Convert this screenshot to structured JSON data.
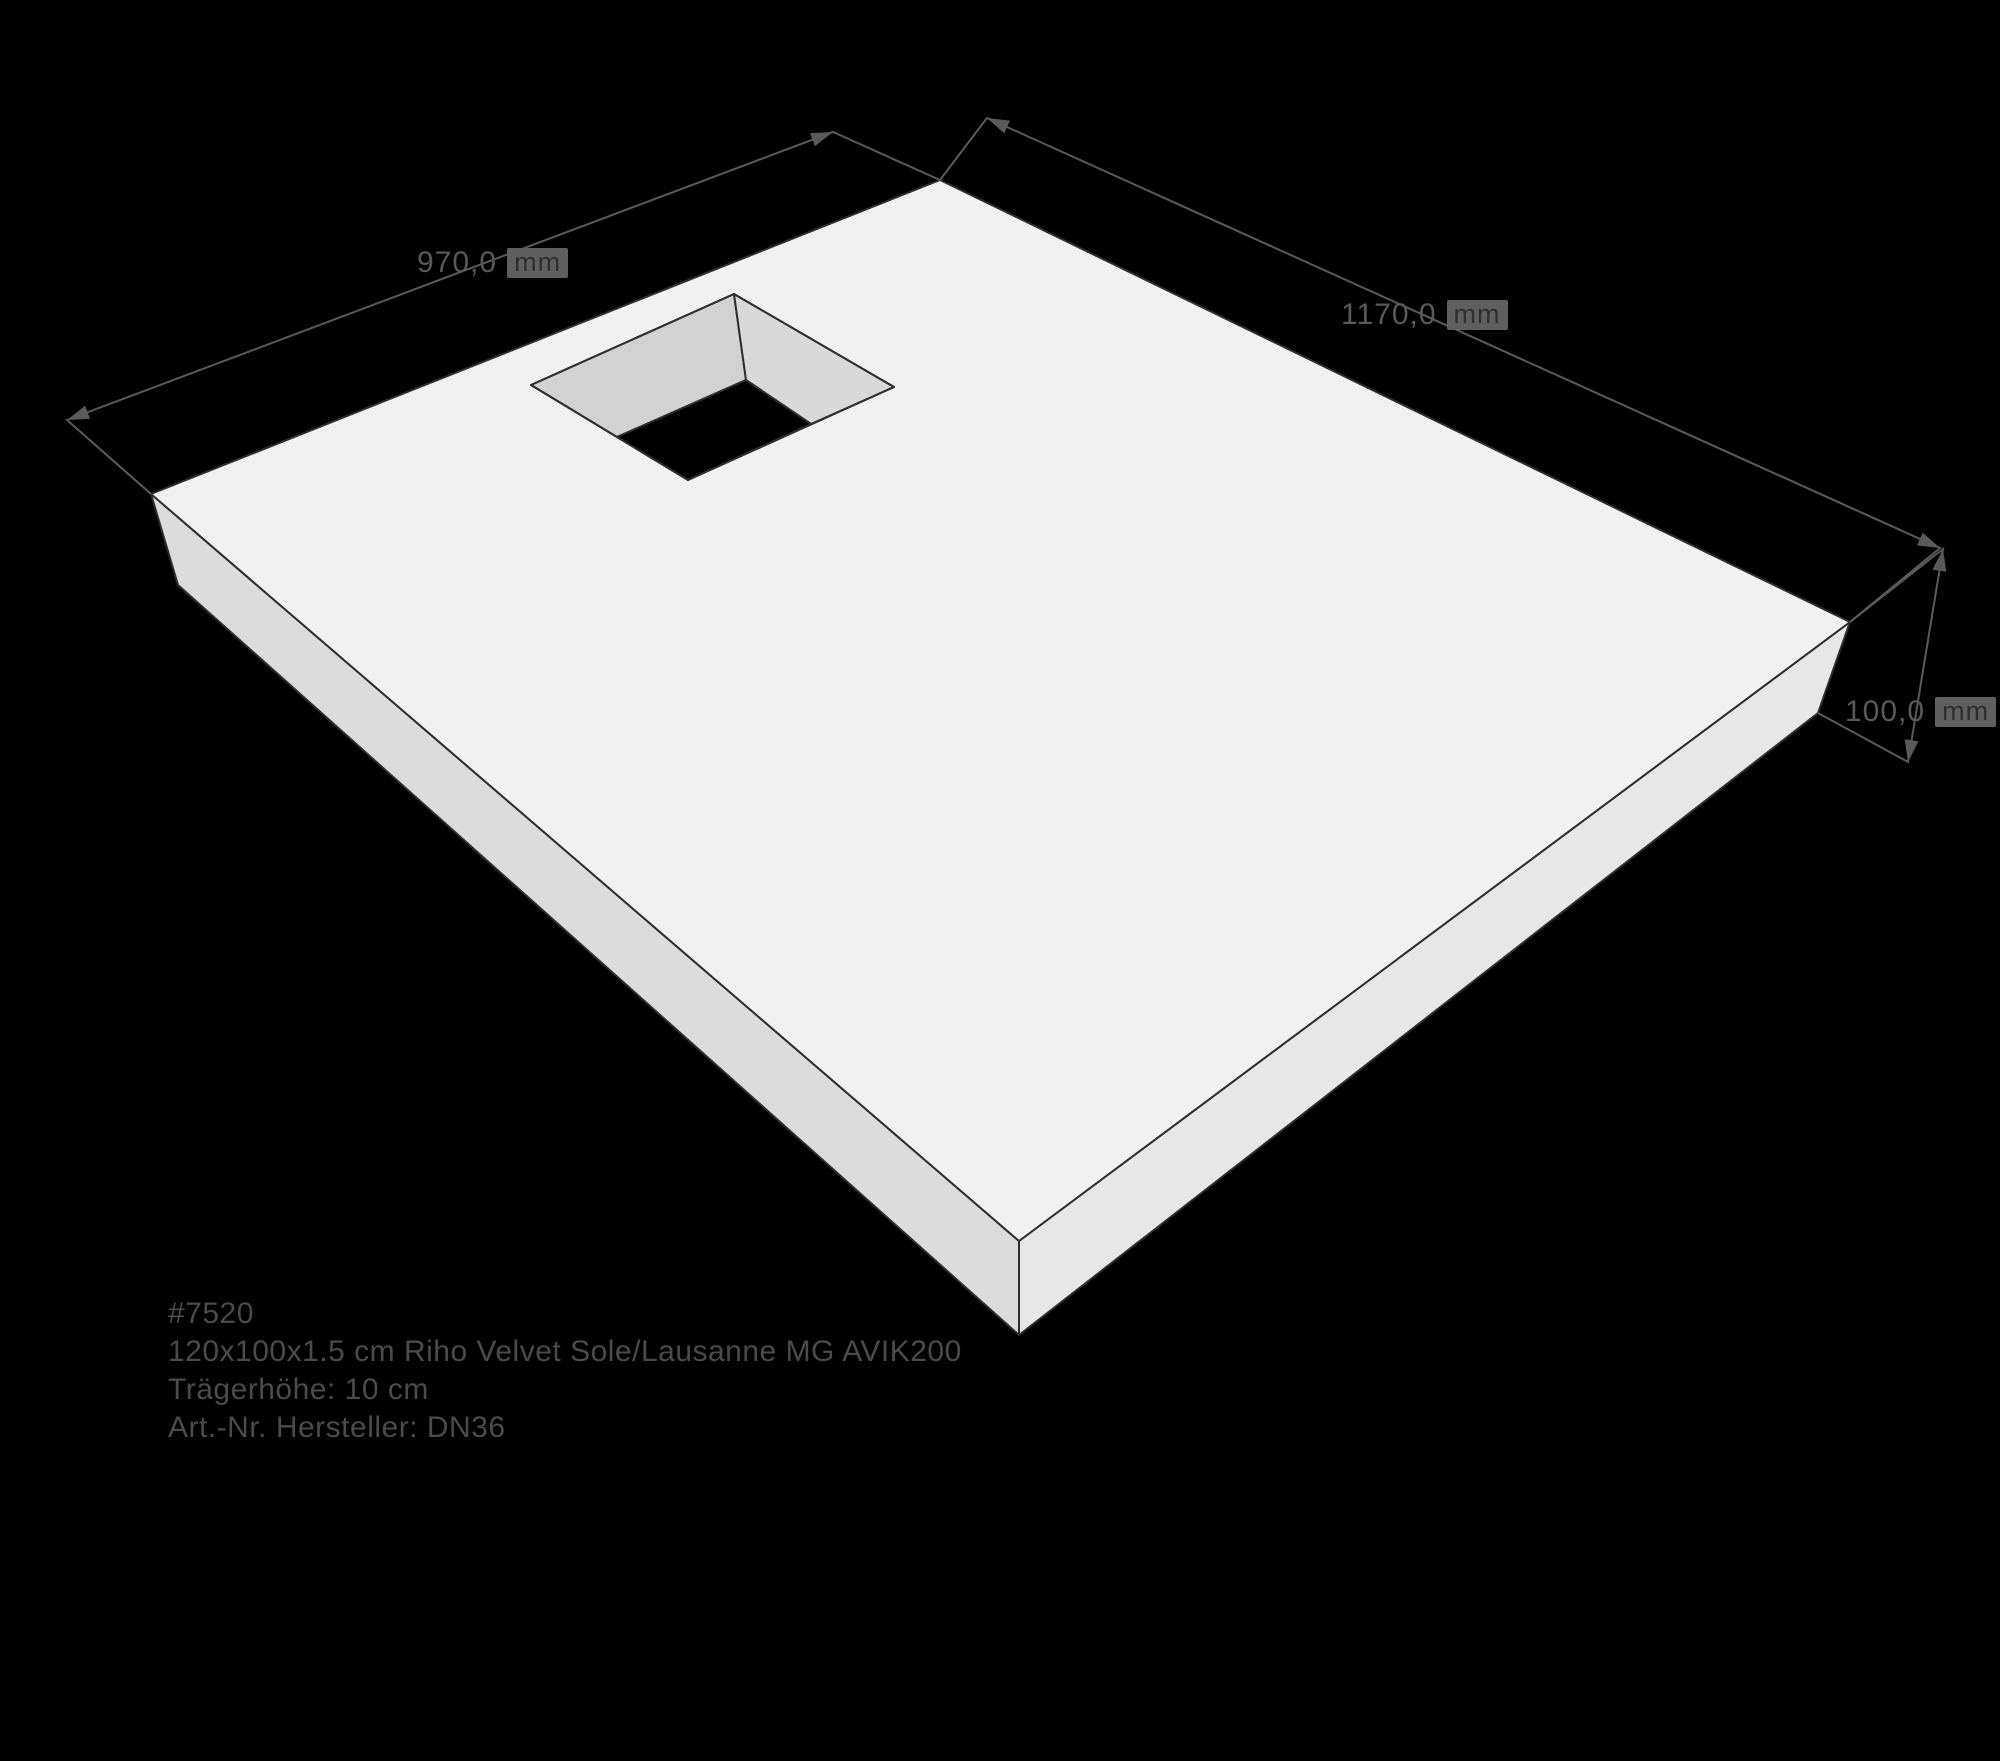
{
  "scene": {
    "type": "3d-product-dimension-diagram",
    "product_info": {
      "lines": [
        "#7520",
        "120x100x1.5 cm Riho Velvet Sole/Lausanne MG AVIK200",
        "Trägerhöhe: 10 cm",
        "Art.-Nr. Hersteller: DN36"
      ]
    },
    "dimensions": {
      "width": {
        "value": "970,0",
        "unit": "mm"
      },
      "length": {
        "value": "1170,0",
        "unit": "mm"
      },
      "height": {
        "value": "100,0",
        "unit": "mm"
      }
    },
    "colors": {
      "background": "#000000",
      "slab_top": "#f1f1f2",
      "slab_side_left": "#dcdcdd",
      "slab_side_right": "#e7e7e8",
      "cutout_wall_left": "#d2d2d3",
      "cutout_wall_right": "#d9d9da",
      "cutout_hole": "#000000",
      "edge_stroke": "#2e2e2e",
      "dimension_line": "#5a5a5a",
      "dimension_text": "#585858",
      "unit_plate": "#5f5f5f",
      "unit_text": "#2f2f2f",
      "info_text": "#4a4a4a"
    }
  }
}
